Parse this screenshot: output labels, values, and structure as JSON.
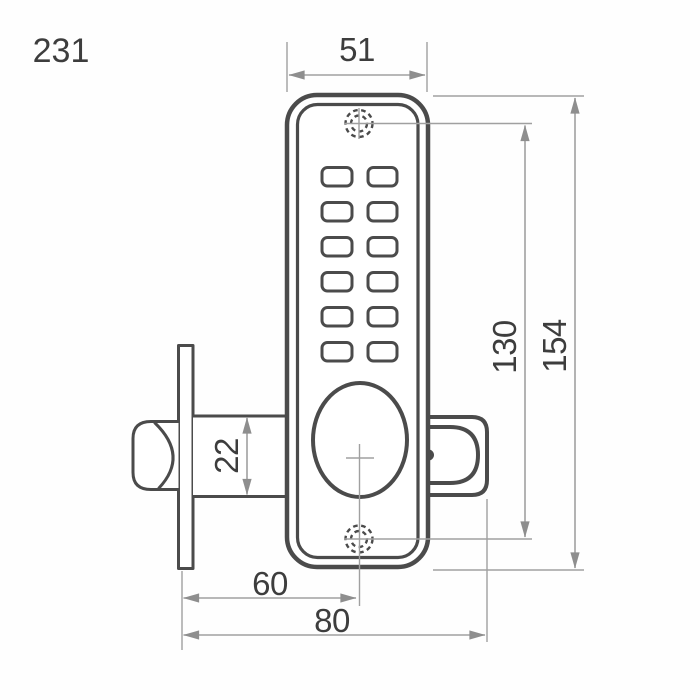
{
  "drawing": {
    "number": "231",
    "dimensions": {
      "face_width": "51",
      "screw_centers": "130",
      "body_height": "154",
      "latch_height": "22",
      "backset": "60",
      "overall_depth": "80"
    },
    "keypad": {
      "rows": 6,
      "columns": 2,
      "buttons": 12
    },
    "colors": {
      "line": "#4b4b4b",
      "dim": "#a0a0a0",
      "arrow": "#8e8e8e",
      "text": "#3d3d3d",
      "bg": "#fefefe"
    }
  }
}
